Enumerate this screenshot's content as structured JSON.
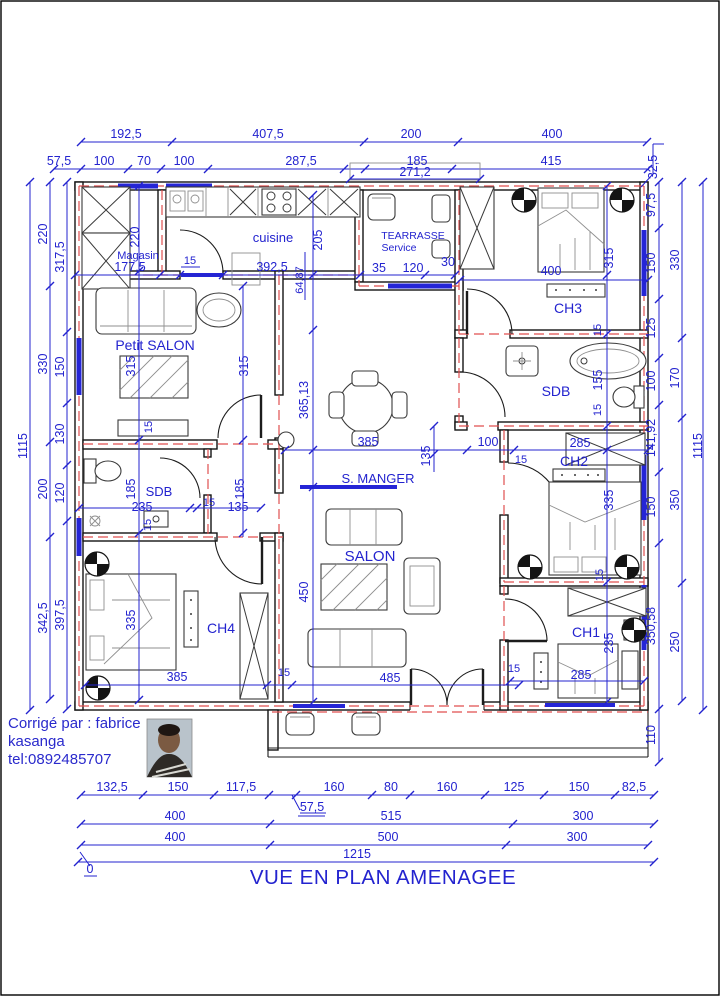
{
  "title": "VUE EN PLAN AMENAGEE",
  "signature": {
    "line1": "Corrigé par : fabrice",
    "line2": "kasanga",
    "line3": "tel:0892485707"
  },
  "rooms": {
    "magasin": "Magasin",
    "cuisine": "cuisine",
    "terrasse_l1": "TEARRASSE",
    "terrasse_l2": "Service",
    "ch3": "CH3",
    "sdb_right": "SDB",
    "ch2": "CH2",
    "petit_salon": "Petit SALON",
    "s_manger": "S. MANGER",
    "sdb_left": "SDB",
    "ch4": "CH4",
    "salon": "SALON",
    "ch1": "CH1"
  },
  "dims": {
    "top1": [
      "192,5",
      "407,5",
      "200",
      "400"
    ],
    "top2": [
      "57,5",
      "100",
      "70",
      "100",
      "287,5",
      "185",
      "415"
    ],
    "top_32_5": "32,5",
    "terrace_width": "271,2",
    "left_outer": "1115",
    "left_mid": [
      "220",
      "330",
      "200",
      "342,5"
    ],
    "left_inner": [
      "317,5",
      "150",
      "130",
      "120",
      "397,5"
    ],
    "right_inner": [
      "97,5",
      "150",
      "125",
      "100",
      "141,92",
      "150",
      "350,58",
      "110"
    ],
    "right_mid": [
      "330",
      "170",
      "350",
      "250"
    ],
    "right_outer": "1115",
    "bottom1": [
      "132,5",
      "150",
      "117,5",
      "160",
      "80",
      "160",
      "125",
      "150",
      "82,5"
    ],
    "bottom_57_5": "57,5",
    "bottom2": [
      "400",
      "515",
      "300"
    ],
    "bottom3": [
      "400",
      "500",
      "300"
    ],
    "bottom_total": "1215",
    "origin": "0"
  },
  "interior": {
    "mag_h": "220",
    "mag_w": "177,5",
    "cu_door": "15",
    "cu_w": "392,5",
    "cu_h": "205",
    "cu_x": "64,87",
    "ter_a": "35",
    "ter_b": "120",
    "ter_c": "30",
    "ch3_w": "400",
    "ch3_h": "315",
    "ch3_t": "15",
    "ps_h1": "315",
    "ps_h2": "315",
    "ps_t": "15",
    "sm_h": "365,13",
    "sm_w": "385",
    "sm_a": "100",
    "sm_b": "135",
    "sdbr_h": "155",
    "sdbr_t": "15",
    "ch2_w": "285",
    "ch2_t": "15",
    "ch2_h": "335",
    "sdbl_h1": "185",
    "sdbl_w": "235",
    "sdbl_t1": "15",
    "sdbl_b": "135",
    "sdbl_h2": "185",
    "sdbl_t2": "15",
    "ch4_h": "335",
    "ch4_w": "385",
    "ch4_t": "15",
    "salon_h": "450",
    "salon_w": "485",
    "ch1_t1": "15",
    "ch1_h": "235",
    "ch1_w": "285",
    "ch1_t2": "15"
  },
  "colors": {
    "dim_blue": "#2323cf",
    "wall_black": "#141414",
    "axis_red": "#e04f4f"
  }
}
